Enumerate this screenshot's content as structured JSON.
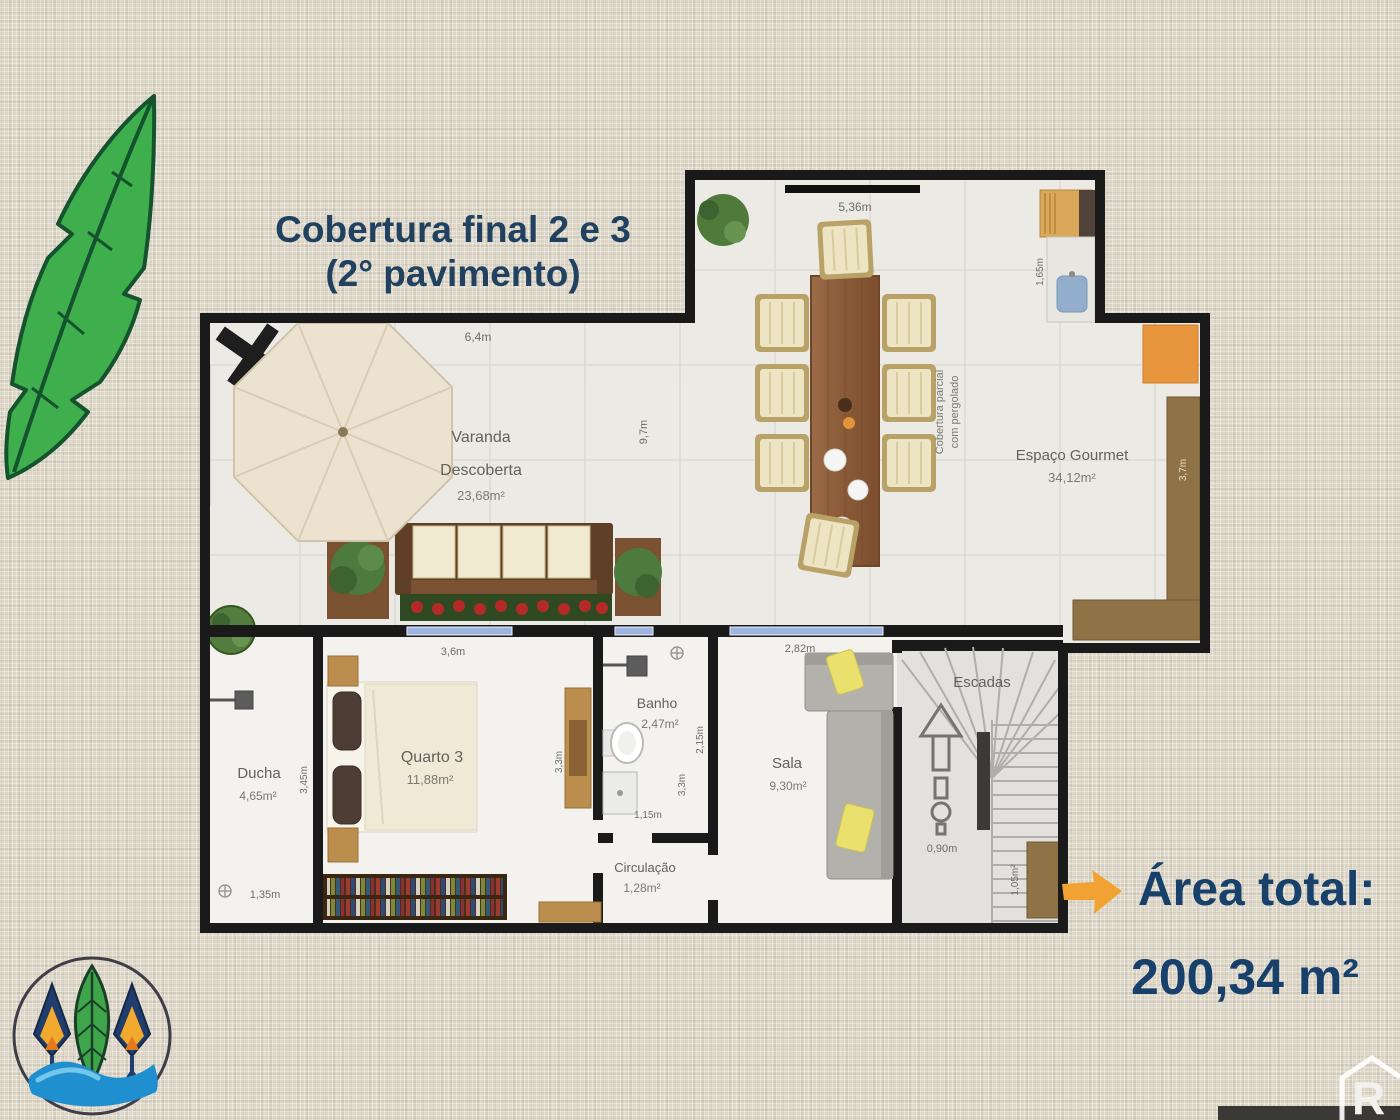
{
  "title": {
    "line1": "Cobertura final 2 e 3",
    "line2": "(2° pavimento)"
  },
  "plan": {
    "rooms": {
      "varanda": {
        "line1": "Varanda",
        "line2": "Descoberta",
        "area": "23,68m²"
      },
      "gourmet": {
        "name": "Espaço Gourmet",
        "area": "34,12m²"
      },
      "pergolado": {
        "line1": "Cobertura parcial",
        "line2": "com pergolado"
      },
      "quarto": {
        "name": "Quarto 3",
        "area": "11,88m²"
      },
      "banho": {
        "name": "Banho",
        "area": "2,47m²"
      },
      "sala": {
        "name": "Sala",
        "area": "9,30m²"
      },
      "escadas": {
        "name": "Escadas"
      },
      "ducha": {
        "name": "Ducha",
        "area": "4,65m²"
      },
      "circulacao": {
        "name": "Circulação",
        "area": "1,28m²"
      }
    },
    "dimensions": {
      "varanda_width": "6,4m",
      "gourmet_width": "5,36m",
      "varanda_depth": "9,7m",
      "counter_width": "1,65m",
      "gourmet_side": "3,7m",
      "quarto_width": "3,6m",
      "sala_width": "2,82m",
      "ducha_depth": "3,45m",
      "quarto_depth": "3,3m",
      "sala_depth": "3,3m",
      "banho_depth": "2,15m",
      "banho_width": "1,15m",
      "ducha_width": "1,35m",
      "stairs_width": "0,90m",
      "stairs_area": "1,05m²"
    }
  },
  "total": {
    "label": "Área total:",
    "value": "200,34 m²"
  },
  "watermark": {
    "letter": "R"
  },
  "colors": {
    "title_navy": "#20415f",
    "arrow_orange": "#f2a233",
    "background": "#ddd6c7",
    "wall": "#1a1a1a"
  }
}
